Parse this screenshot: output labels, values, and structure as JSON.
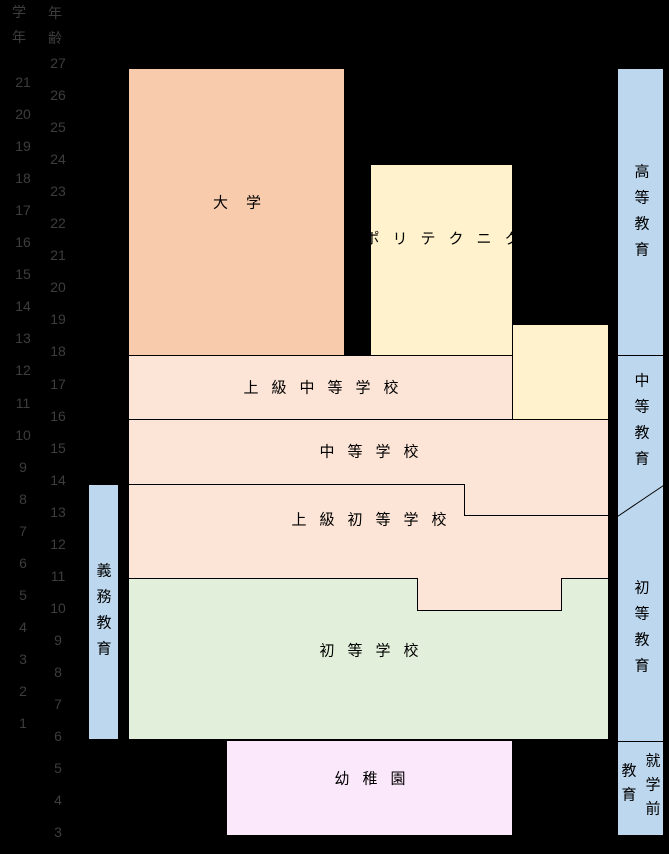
{
  "diagram_title": "education-system-chart",
  "columns": {
    "grade": {
      "header": "学年",
      "values": [
        21,
        20,
        19,
        18,
        17,
        16,
        15,
        14,
        13,
        12,
        11,
        10,
        9,
        8,
        7,
        6,
        5,
        4,
        3,
        2,
        1
      ]
    },
    "age": {
      "header": "年齢",
      "values": [
        27,
        26,
        25,
        24,
        23,
        22,
        21,
        20,
        19,
        18,
        17,
        16,
        15,
        14,
        13,
        12,
        11,
        10,
        9,
        8,
        7,
        6,
        5,
        4,
        3
      ]
    }
  },
  "boxes": {
    "university": {
      "label": "大学"
    },
    "polytechnic": {
      "label": "ポリテクニク"
    },
    "upper_secondary": {
      "label": "上級中等学校"
    },
    "secondary": {
      "label": "中等学校"
    },
    "upper_primary": {
      "label": "上級初等学校"
    },
    "primary": {
      "label": "初等学校"
    },
    "kindergarten": {
      "label": "幼稚園"
    }
  },
  "side_bars": {
    "compulsory": {
      "label": "義務教育"
    },
    "higher": {
      "label": "高等教育"
    },
    "secondary": {
      "label": "中等教育"
    },
    "primary": {
      "label": "初等教育"
    },
    "preschool": {
      "line1": "就学前",
      "line2": "教育"
    }
  },
  "colors": {
    "background": "#000000",
    "university": "#F8CBAD",
    "polytechnic": "#FFF2CC",
    "secondary_family": "#FCE4D6",
    "primary_green": "#E2EFDA",
    "kindergarten": "#FCE8FB",
    "bar_blue": "#BDD7EE",
    "line": "#000000",
    "scale_text": "#3d3d3d"
  }
}
